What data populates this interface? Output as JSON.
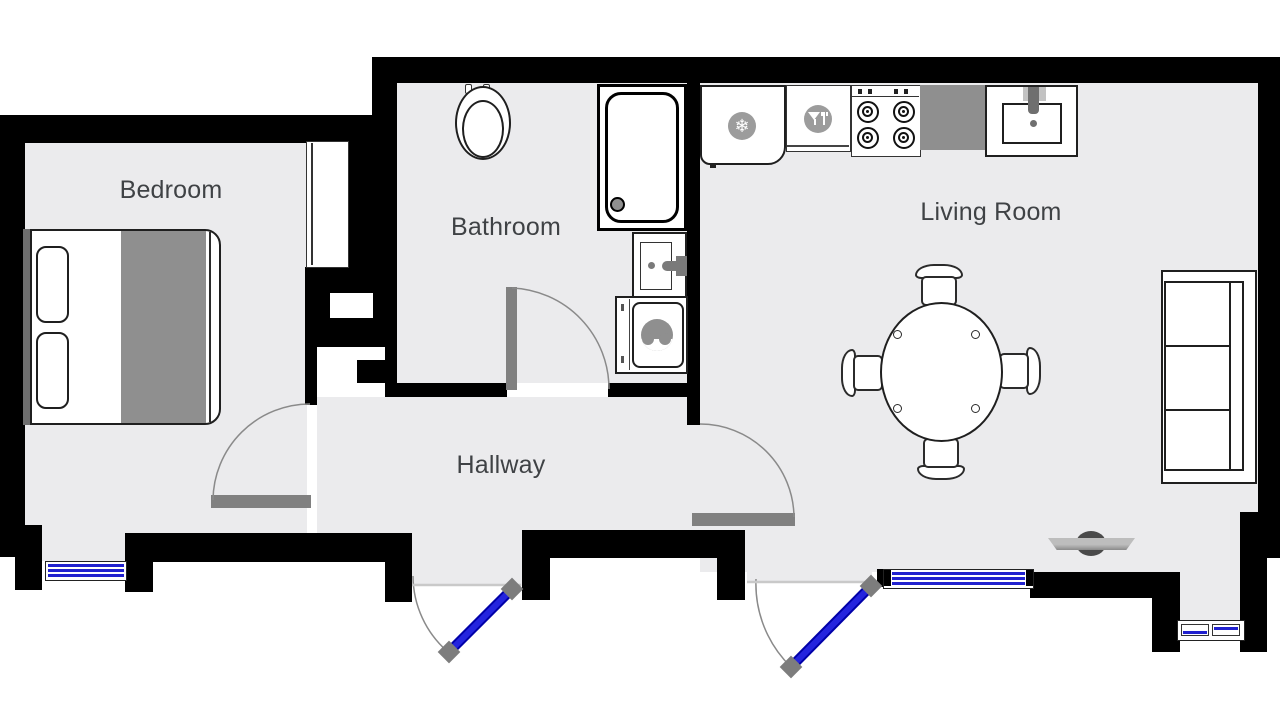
{
  "floor_plan": {
    "rooms": {
      "bedroom": {
        "label": "Bedroom"
      },
      "bathroom": {
        "label": "Bathroom"
      },
      "living_room": {
        "label": "Living Room"
      },
      "hallway": {
        "label": "Hallway"
      }
    },
    "furniture": [
      "double-bed",
      "wardrobe",
      "toilet",
      "shower",
      "bathroom-sink",
      "washing-machine",
      "fridge",
      "dishwasher",
      "stove",
      "kitchen-counter",
      "kitchen-sink",
      "dining-table",
      "dining-chairs",
      "sofa",
      "tv"
    ],
    "icons": {
      "snowflake": {
        "glyph": "❄",
        "meaning": "fridge"
      },
      "dining": {
        "meaning": "dishwasher"
      }
    },
    "doors": {
      "entrance_doors": 2,
      "interior_doors": [
        "bedroom",
        "bathroom",
        "living-room"
      ],
      "door_color": "#2424de",
      "hinge_color": "#7d7d7d"
    },
    "windows": {
      "count": 3,
      "stripe_color": "#2121cf"
    },
    "colors": {
      "wall": "#000000",
      "floor": "#ebebed",
      "furniture_gray": "#8f8f8f",
      "threshold_gray": "#808080",
      "text": "#3f4245"
    }
  }
}
